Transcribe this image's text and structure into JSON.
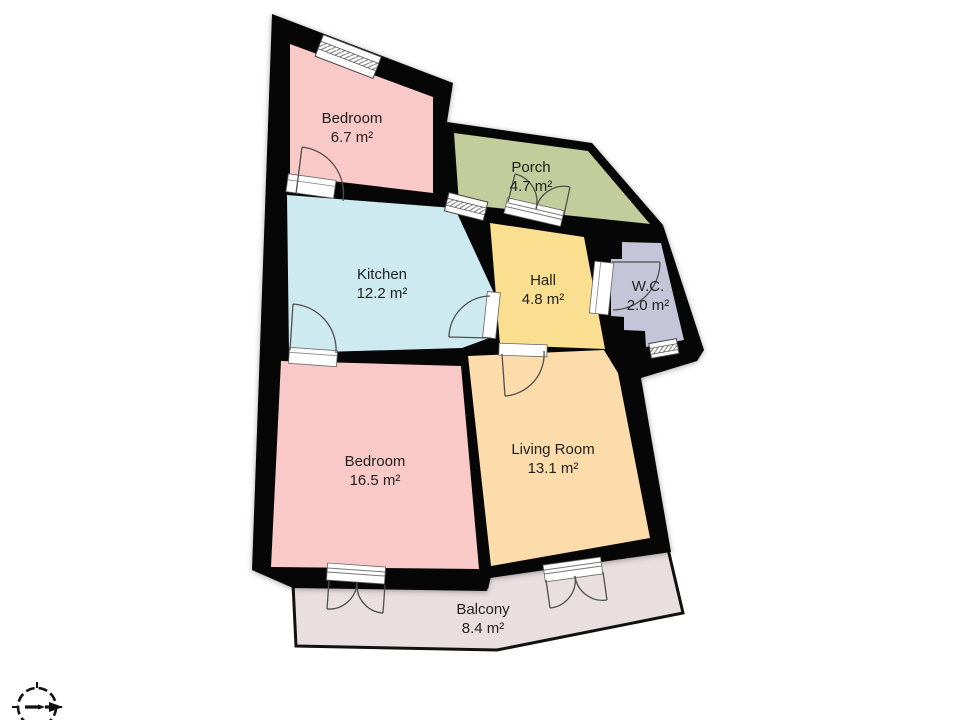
{
  "title": "Apartment floor plan",
  "floor_plan": {
    "wall_color": "#060606",
    "background": "#ffffff",
    "symbol_line_color": "#4f4f4f",
    "rooms": [
      {
        "id": "bedroom-1",
        "name": "Bedroom",
        "area": "6.7 m²",
        "color": "#f9c9c7"
      },
      {
        "id": "porch",
        "name": "Porch",
        "area": "4.7 m²",
        "color": "#c3cc9b"
      },
      {
        "id": "kitchen",
        "name": "Kitchen",
        "area": "12.2 m²",
        "color": "#cdeaf1"
      },
      {
        "id": "hall",
        "name": "Hall",
        "area": "4.8 m²",
        "color": "#fadf90"
      },
      {
        "id": "wc",
        "name": "W.C.",
        "area": "2.0 m²",
        "color": "#c5c5d9"
      },
      {
        "id": "bedroom-2",
        "name": "Bedroom",
        "area": "16.5 m²",
        "color": "#f9c9c7"
      },
      {
        "id": "living-room",
        "name": "Living Room",
        "area": "13.1 m²",
        "color": "#fcdcab"
      },
      {
        "id": "balcony",
        "name": "Balcony",
        "area": "8.4 m²",
        "color": "#e9dfe1"
      }
    ],
    "compass": {
      "arrow_direction": "right"
    }
  }
}
